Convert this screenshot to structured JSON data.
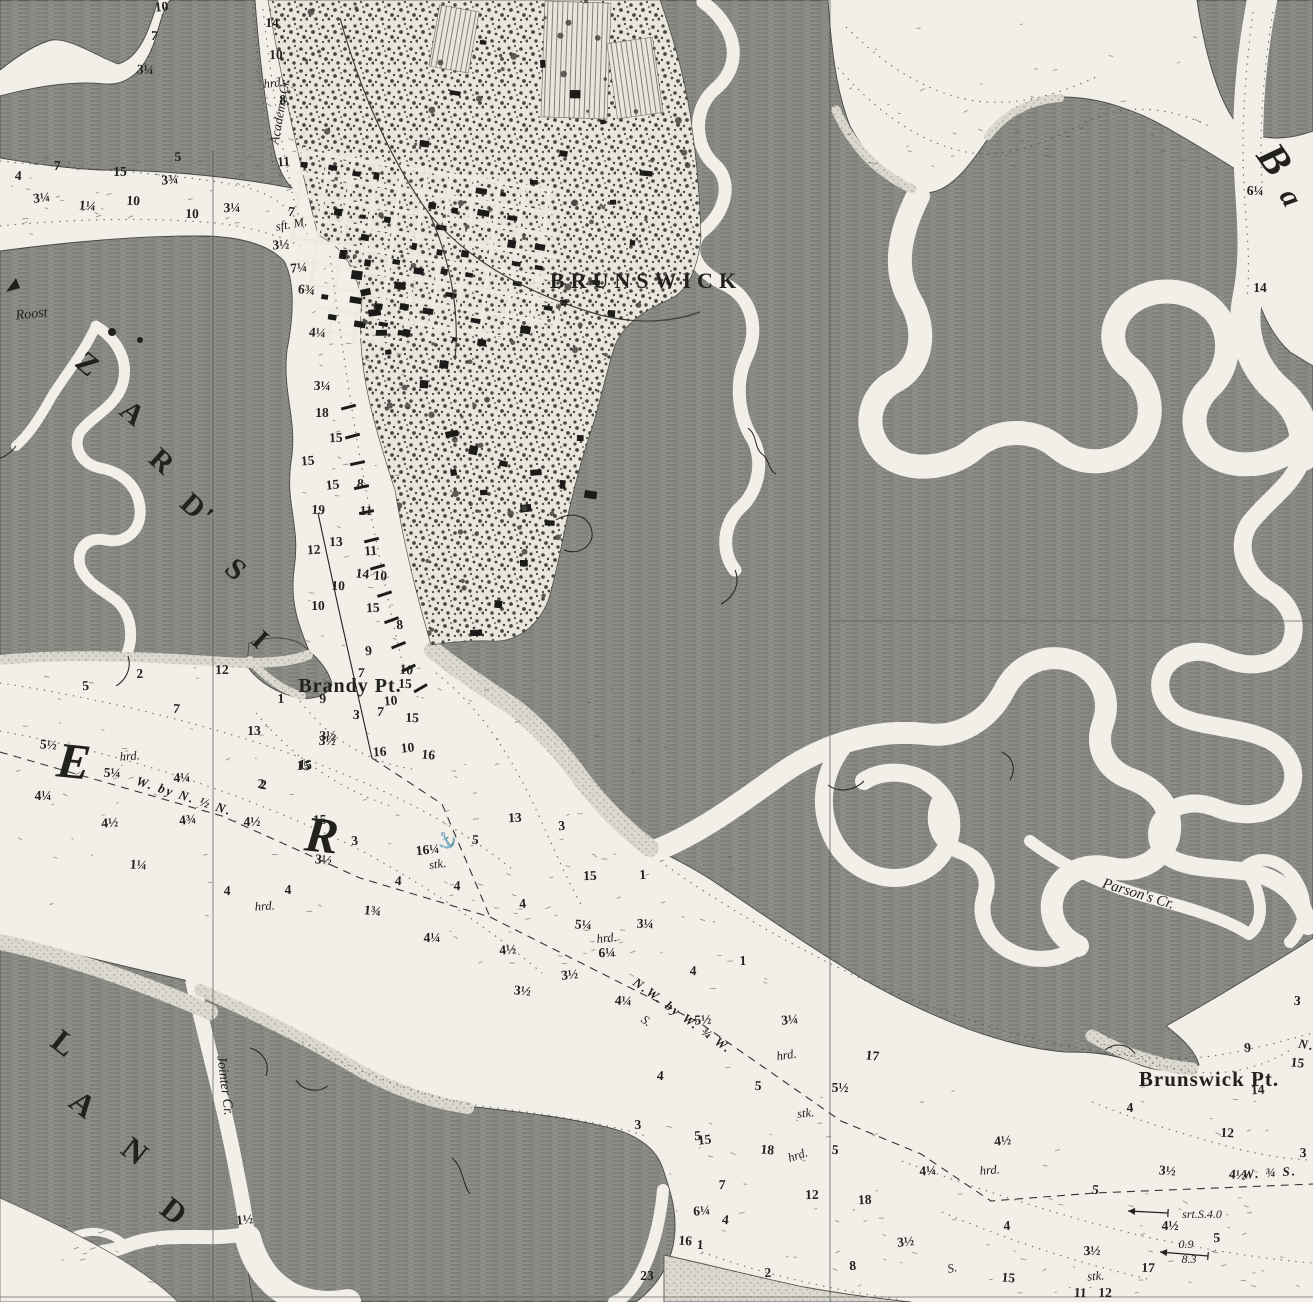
{
  "map": {
    "colors": {
      "paper": "#f1efe7",
      "marsh": "#8e8e89",
      "marsh_hatch": "#6a6a65",
      "ink": "#22211d",
      "sand": "#dbd9cf"
    },
    "place_labels": [
      {
        "text": "BRUNSWICK",
        "x": 646,
        "y": 288,
        "size": 22,
        "rot": 0,
        "ls": 6,
        "style": "roman"
      },
      {
        "text": "Brandy Pt.",
        "x": 350,
        "y": 692,
        "size": 20,
        "rot": 0,
        "ls": 1,
        "style": "roman"
      },
      {
        "text": "Brunswick Pt.",
        "x": 1209,
        "y": 1086,
        "size": 21,
        "rot": 0,
        "ls": 1,
        "style": "roman"
      },
      {
        "text": "Roost",
        "x": 32,
        "y": 318,
        "size": 14,
        "rot": -6,
        "style": "italic"
      },
      {
        "text": "Academy Cr.",
        "x": 284,
        "y": 112,
        "size": 13,
        "rot": -80,
        "style": "italic"
      },
      {
        "text": "Jointer Cr.",
        "x": 221,
        "y": 1086,
        "size": 14,
        "rot": 83,
        "style": "italic"
      },
      {
        "text": "Parson's Cr.",
        "x": 1137,
        "y": 898,
        "size": 15,
        "rot": 17,
        "style": "italic"
      }
    ],
    "large_letters": [
      {
        "ch": "Z",
        "x": 82,
        "y": 372,
        "rot": 40,
        "size": 30
      },
      {
        "ch": "A",
        "x": 127,
        "y": 421,
        "rot": 40,
        "size": 30
      },
      {
        "ch": "R",
        "x": 156,
        "y": 469,
        "rot": 42,
        "size": 30
      },
      {
        "ch": "D'",
        "x": 191,
        "y": 517,
        "rot": 42,
        "size": 30
      },
      {
        "ch": "S",
        "x": 230,
        "y": 577,
        "rot": 42,
        "size": 30
      },
      {
        "ch": "I",
        "x": 255,
        "y": 647,
        "rot": 42,
        "size": 28
      },
      {
        "ch": "E",
        "x": 73,
        "y": 778,
        "rot": 6,
        "size": 50,
        "it": true
      },
      {
        "ch": "R",
        "x": 321,
        "y": 852,
        "rot": 6,
        "size": 50,
        "it": true
      },
      {
        "ch": "B",
        "x": 1264,
        "y": 168,
        "rot": 55,
        "size": 42,
        "it": true
      },
      {
        "ch": "a",
        "x": 1283,
        "y": 203,
        "rot": 60,
        "size": 30,
        "it": true
      },
      {
        "ch": "L",
        "x": 58,
        "y": 1052,
        "rot": 38,
        "size": 32
      },
      {
        "ch": "A",
        "x": 77,
        "y": 1113,
        "rot": 38,
        "size": 32
      },
      {
        "ch": "N",
        "x": 129,
        "y": 1160,
        "rot": 38,
        "size": 32
      },
      {
        "ch": "D",
        "x": 168,
        "y": 1220,
        "rot": 38,
        "size": 32
      }
    ],
    "bearings": [
      {
        "text": "W. by N. ½ N.",
        "x": 183,
        "y": 800,
        "rot": 18
      },
      {
        "text": "N.W. by W. ¾ W.",
        "x": 680,
        "y": 1019,
        "rot": 36
      },
      {
        "text": "W. ¾ S.",
        "x": 1270,
        "y": 1177,
        "rot": -4
      },
      {
        "text": "N.",
        "x": 1306,
        "y": 1049,
        "rot": 10
      }
    ],
    "bottom_notes": [
      [
        "hrd.",
        274,
        87,
        -6
      ],
      [
        "hrd.",
        130,
        760,
        -4
      ],
      [
        "hrd.",
        265,
        910,
        -4
      ],
      [
        "hrd.",
        607,
        942,
        -6
      ],
      [
        "hrd.",
        787,
        1059,
        -8
      ],
      [
        "hrd.",
        799,
        1159,
        -18
      ],
      [
        "hrd.",
        990,
        1174,
        -4
      ],
      [
        "stk.",
        438,
        868,
        -8
      ],
      [
        "stk.",
        806,
        1117,
        -6
      ],
      [
        "stk.",
        1096,
        1280,
        -4
      ],
      [
        "S.",
        953,
        1272,
        -12
      ],
      [
        "sft. M.",
        292,
        228,
        -10
      ],
      [
        "S.",
        644,
        1024,
        36
      ]
    ],
    "currents": [
      {
        "text": "srt.S.4.0",
        "tx": 1202,
        "ty": 1218,
        "x1": 1168,
        "y1": 1213,
        "x2": 1128,
        "y2": 1211
      },
      {
        "text": "0.9",
        "tx": 1186,
        "ty": 1248,
        "text2": "8.3",
        "t2x": 1189,
        "t2y": 1263,
        "x1": 1208,
        "y1": 1256,
        "x2": 1160,
        "y2": 1252
      }
    ],
    "anchor_symbol": {
      "glyph": "⚓",
      "x": 449,
      "y": 845,
      "rot": -28
    },
    "soundings": [
      [
        "10",
        162,
        11
      ],
      [
        "7",
        154,
        40
      ],
      [
        "3¼",
        145,
        74
      ],
      [
        "14",
        272,
        27
      ],
      [
        "10",
        276,
        59
      ],
      [
        "8",
        283,
        104
      ],
      [
        "11",
        284,
        166
      ],
      [
        "7",
        291,
        216
      ],
      [
        "4",
        18,
        180
      ],
      [
        "7",
        57,
        170
      ],
      [
        "15",
        120,
        176
      ],
      [
        "5",
        178,
        161
      ],
      [
        "3¾",
        170,
        184
      ],
      [
        "3¼",
        42,
        202
      ],
      [
        "1¼",
        87,
        210
      ],
      [
        "10",
        133,
        205
      ],
      [
        "10",
        192,
        218
      ],
      [
        "3¼",
        232,
        212
      ],
      [
        "3½",
        281,
        249
      ],
      [
        "7¼",
        299,
        272
      ],
      [
        "6¾",
        306,
        294
      ],
      [
        "4¼",
        317,
        337
      ],
      [
        "3¼",
        322,
        390
      ],
      [
        "18",
        322,
        417
      ],
      [
        "15",
        336,
        442
      ],
      [
        "15",
        308,
        465
      ],
      [
        "15",
        333,
        489
      ],
      [
        "8",
        360,
        488
      ],
      [
        "19",
        318,
        514
      ],
      [
        "11",
        366,
        515
      ],
      [
        "13",
        336,
        546
      ],
      [
        "12",
        314,
        554
      ],
      [
        "11",
        371,
        555
      ],
      [
        "14",
        362,
        578
      ],
      [
        "10",
        380,
        580
      ],
      [
        "10",
        338,
        590
      ],
      [
        "10",
        318,
        610
      ],
      [
        "15",
        373,
        612
      ],
      [
        "8",
        400,
        629
      ],
      [
        "9",
        369,
        655
      ],
      [
        "10",
        406,
        674
      ],
      [
        "7",
        361,
        677
      ],
      [
        "15",
        405,
        688
      ],
      [
        "1",
        281,
        703
      ],
      [
        "9",
        323,
        703
      ],
      [
        "10",
        391,
        705
      ],
      [
        "7",
        380,
        716
      ],
      [
        "3",
        356,
        719
      ],
      [
        "15",
        412,
        722
      ],
      [
        "13",
        254,
        735
      ],
      [
        "3½",
        328,
        740
      ],
      [
        "16",
        380,
        756
      ],
      [
        "10",
        408,
        752
      ],
      [
        "16",
        428,
        759
      ],
      [
        "15",
        305,
        769
      ],
      [
        "2",
        261,
        788
      ],
      [
        "12",
        222,
        674
      ],
      [
        "2",
        140,
        678
      ],
      [
        "5",
        86,
        690
      ],
      [
        "7",
        176,
        713
      ],
      [
        "5½",
        48,
        749
      ],
      [
        "5¼",
        112,
        777
      ],
      [
        "4¼",
        43,
        800
      ],
      [
        "4¼",
        182,
        782
      ],
      [
        "4½",
        110,
        827
      ],
      [
        "4¾",
        188,
        824
      ],
      [
        "2",
        263,
        789
      ],
      [
        "15",
        303,
        770
      ],
      [
        "3½",
        327,
        745
      ],
      [
        "4½",
        252,
        826
      ],
      [
        "15",
        320,
        824
      ],
      [
        "3",
        355,
        845
      ],
      [
        "3½",
        323,
        864
      ],
      [
        "1¼",
        138,
        869
      ],
      [
        "4",
        227,
        895
      ],
      [
        "4",
        288,
        894
      ],
      [
        "13",
        515,
        822
      ],
      [
        "3",
        562,
        830
      ],
      [
        "16¼",
        428,
        854
      ],
      [
        "5",
        475,
        844
      ],
      [
        "4",
        398,
        885
      ],
      [
        "4",
        457,
        890
      ],
      [
        "15",
        590,
        880
      ],
      [
        "1",
        643,
        879
      ],
      [
        "4",
        523,
        908
      ],
      [
        "1¾",
        372,
        915
      ],
      [
        "5¼",
        583,
        929
      ],
      [
        "3¼",
        645,
        928
      ],
      [
        "4¼",
        432,
        942
      ],
      [
        "6¼",
        607,
        957
      ],
      [
        "4½",
        508,
        954
      ],
      [
        "3½",
        570,
        979
      ],
      [
        "3½",
        522,
        995
      ],
      [
        "4¼",
        623,
        1005
      ],
      [
        "4",
        693,
        975
      ],
      [
        "1",
        743,
        965
      ],
      [
        "5½",
        703,
        1024
      ],
      [
        "3¼",
        790,
        1024
      ],
      [
        "17",
        872,
        1060
      ],
      [
        "4",
        660,
        1080
      ],
      [
        "5",
        758,
        1090
      ],
      [
        "5½",
        840,
        1092
      ],
      [
        "3",
        638,
        1129
      ],
      [
        "5",
        698,
        1140
      ],
      [
        "15",
        705,
        1144
      ],
      [
        "18",
        767,
        1154
      ],
      [
        "5",
        835,
        1154
      ],
      [
        "7",
        722,
        1189
      ],
      [
        "12",
        812,
        1199
      ],
      [
        "18",
        865,
        1204
      ],
      [
        "6¼",
        702,
        1215
      ],
      [
        "4",
        725,
        1224
      ],
      [
        "16",
        685,
        1245
      ],
      [
        "1",
        700,
        1249
      ],
      [
        "23",
        647,
        1280
      ],
      [
        "2",
        768,
        1277
      ],
      [
        "8",
        853,
        1270
      ],
      [
        "3½",
        906,
        1246
      ],
      [
        "15",
        1008,
        1282
      ],
      [
        "11",
        1080,
        1297
      ],
      [
        "12",
        1105,
        1297
      ],
      [
        "3½",
        1092,
        1255
      ],
      [
        "4¼",
        928,
        1175
      ],
      [
        "4½",
        1003,
        1145
      ],
      [
        "5",
        1095,
        1194
      ],
      [
        "3½",
        1167,
        1175
      ],
      [
        "17",
        1148,
        1272
      ],
      [
        "4½",
        1170,
        1230
      ],
      [
        "4",
        1007,
        1230
      ],
      [
        "5",
        1217,
        1242
      ],
      [
        "1½",
        245,
        1224
      ],
      [
        "4½",
        1237,
        1179
      ],
      [
        "12",
        1227,
        1137
      ],
      [
        "3",
        1303,
        1157
      ],
      [
        "4",
        1130,
        1112
      ],
      [
        "14",
        1258,
        1094
      ],
      [
        "9",
        1248,
        1052
      ],
      [
        "15",
        1297,
        1067
      ],
      [
        "3",
        1297,
        1005
      ],
      [
        "6¼",
        1255,
        195
      ],
      [
        "14",
        1260,
        292
      ]
    ]
  }
}
